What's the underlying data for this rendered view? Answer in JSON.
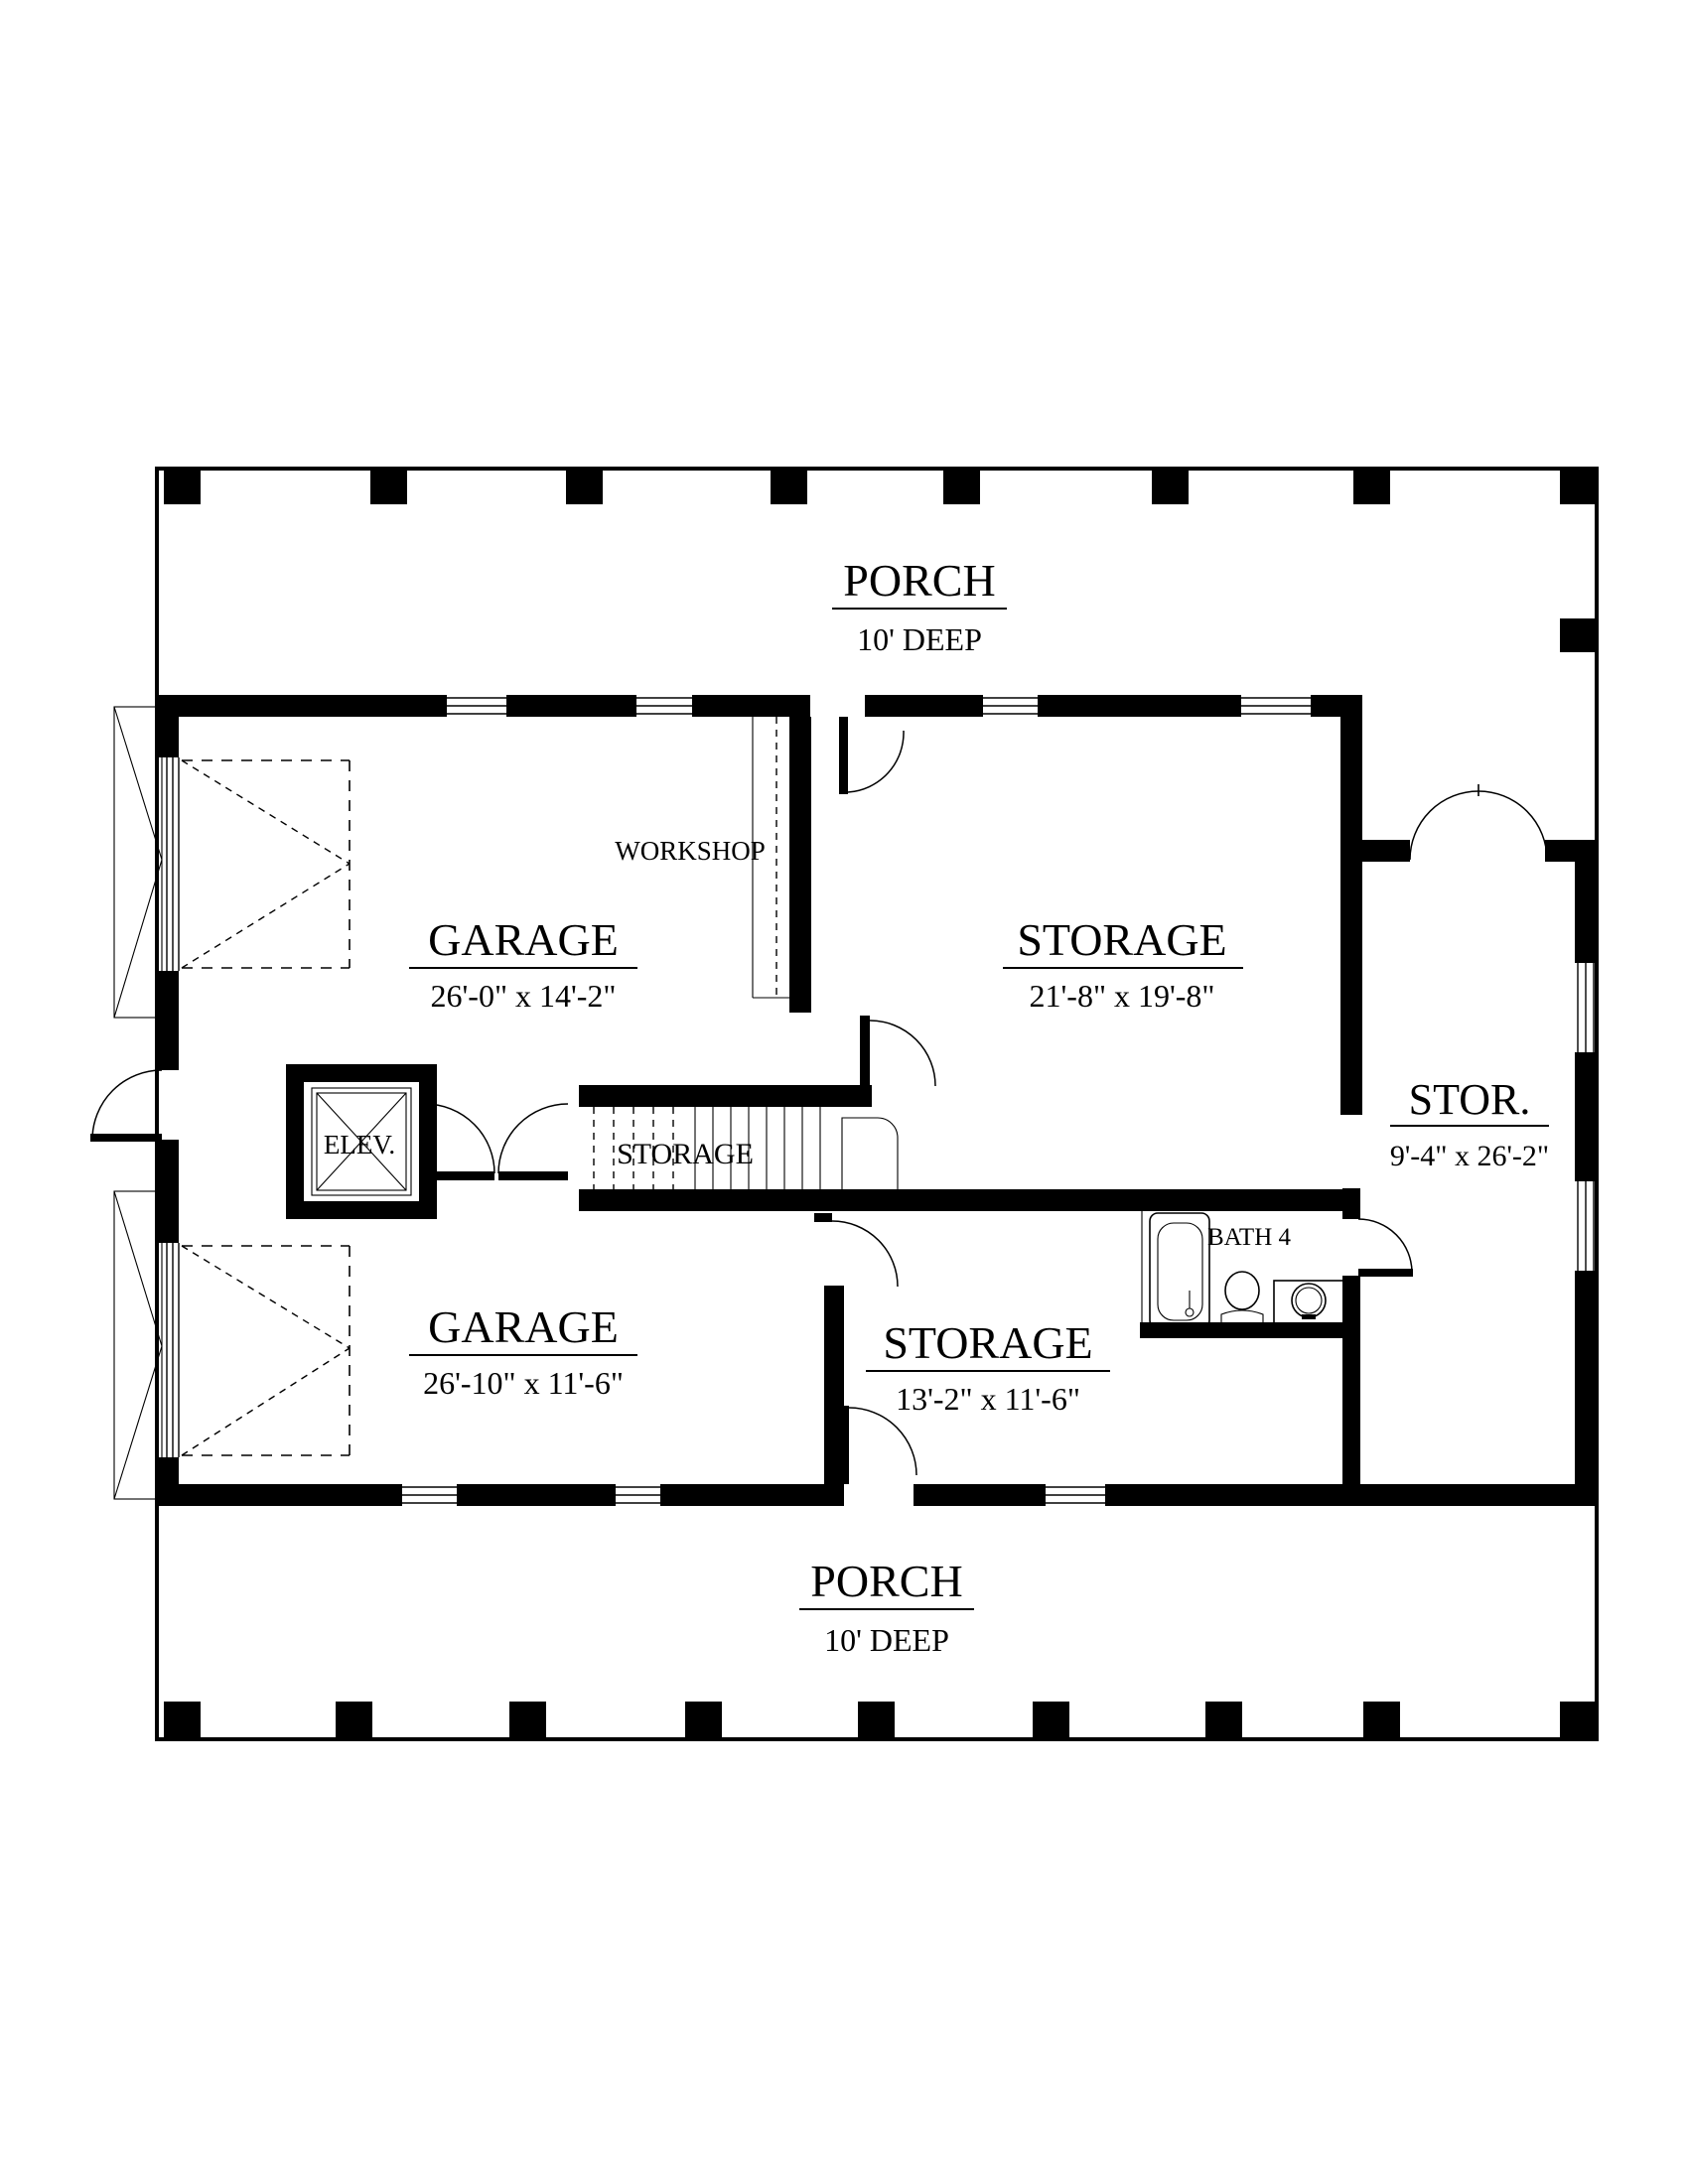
{
  "plan": {
    "type": "architectural-floor-plan",
    "ink_color": "#000000",
    "paper_color": "#ffffff",
    "rooms": {
      "porch_top": {
        "name": "PORCH",
        "dims": "10' DEEP"
      },
      "garage_top": {
        "name": "GARAGE",
        "dims": "26'-0\" x 14'-2\""
      },
      "workshop": {
        "name": "WORKSHOP"
      },
      "storage_main": {
        "name": "STORAGE",
        "dims": "21'-8\" x 19'-8\""
      },
      "stor_right": {
        "name": "STOR.",
        "dims": "9'-4\" x 26'-2\""
      },
      "elevator": {
        "name": "ELEV."
      },
      "storage_stairs": {
        "name": "STORAGE"
      },
      "bath": {
        "name": "BATH 4"
      },
      "garage_bottom": {
        "name": "GARAGE",
        "dims": "26'-10\" x 11'-6\""
      },
      "storage_bottom": {
        "name": "STORAGE",
        "dims": "13'-2\" x 11'-6\""
      },
      "porch_bottom": {
        "name": "PORCH",
        "dims": "10' DEEP"
      }
    }
  }
}
